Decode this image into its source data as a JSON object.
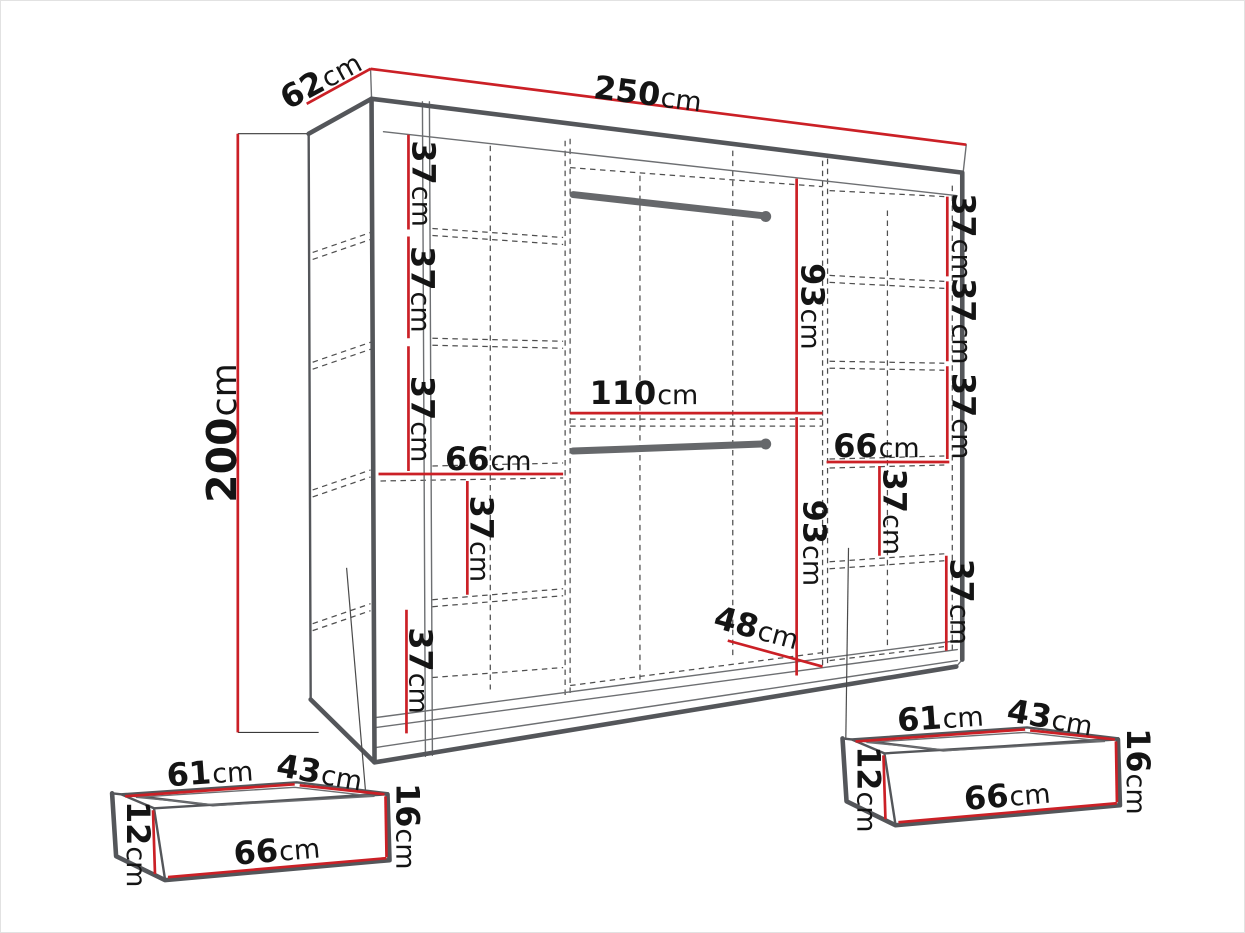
{
  "diagram": {
    "type": "furniture-dimension-diagram",
    "subject": "sliding-door wardrobe with interior layout and two under-drawers",
    "colors": {
      "dimension_red": "#cb2026",
      "edge_gray": "#54565a",
      "rail_gray": "#66686b",
      "hidden_line_gray": "#4f4f4f",
      "text": "#141414",
      "background": "#ffffff"
    },
    "wardrobe": {
      "width": {
        "value": "250",
        "unit": "cm"
      },
      "depth": {
        "value": "62",
        "unit": "cm"
      },
      "height": {
        "value": "200",
        "unit": "cm"
      },
      "left_column": {
        "gaps": [
          {
            "value": "37",
            "unit": "cm"
          },
          {
            "value": "37",
            "unit": "cm"
          },
          {
            "value": "37",
            "unit": "cm"
          },
          {
            "value": "37",
            "unit": "cm"
          },
          {
            "value": "37",
            "unit": "cm"
          }
        ],
        "shelf_width": {
          "value": "66",
          "unit": "cm"
        }
      },
      "center_section": {
        "upper_hang_height": {
          "value": "93",
          "unit": "cm"
        },
        "shelf_width": {
          "value": "110",
          "unit": "cm"
        },
        "lower_hang_height": {
          "value": "93",
          "unit": "cm"
        },
        "bottom_width": {
          "value": "48",
          "unit": "cm"
        }
      },
      "right_column": {
        "gaps": [
          {
            "value": "37",
            "unit": "cm"
          },
          {
            "value": "37",
            "unit": "cm"
          },
          {
            "value": "37",
            "unit": "cm"
          },
          {
            "value": "37",
            "unit": "cm"
          },
          {
            "value": "37",
            "unit": "cm"
          }
        ],
        "shelf_width": {
          "value": "66",
          "unit": "cm"
        }
      }
    },
    "drawers": {
      "left": {
        "inner_width": {
          "value": "61",
          "unit": "cm"
        },
        "inner_depth": {
          "value": "43",
          "unit": "cm"
        },
        "side_height": {
          "value": "12",
          "unit": "cm"
        },
        "front_width": {
          "value": "66",
          "unit": "cm"
        },
        "front_height": {
          "value": "16",
          "unit": "cm"
        }
      },
      "right": {
        "inner_width": {
          "value": "61",
          "unit": "cm"
        },
        "inner_depth": {
          "value": "43",
          "unit": "cm"
        },
        "side_height": {
          "value": "12",
          "unit": "cm"
        },
        "front_width": {
          "value": "66",
          "unit": "cm"
        },
        "front_height": {
          "value": "16",
          "unit": "cm"
        }
      }
    }
  }
}
